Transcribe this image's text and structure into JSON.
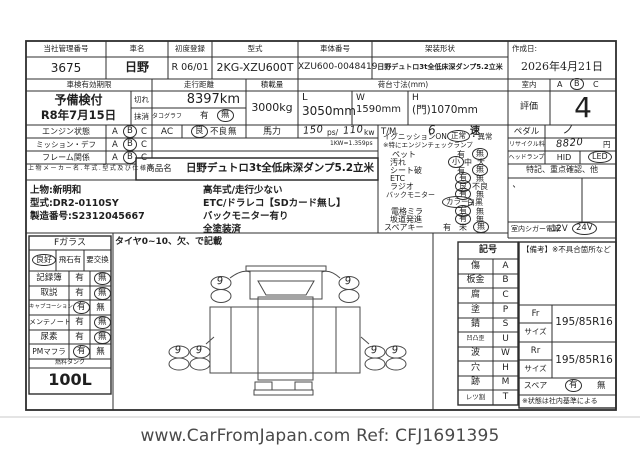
{
  "colors": {
    "ink": "#2d2d2d",
    "paper": "#ffffff",
    "footer_text": "#4a4a4a"
  },
  "top_table": {
    "cols": [
      {
        "label": "当社管理番号",
        "value": "3675"
      },
      {
        "label": "車名",
        "value": "日野"
      },
      {
        "label": "初度登録",
        "value": "R 06/01"
      },
      {
        "label": "型式",
        "value": "2KG-XZU600T"
      },
      {
        "label": "車体番号",
        "value": "XZU600-0048419"
      },
      {
        "label": "架装形状",
        "value": "日野デュトロ3t全低床深ダンプ5.2立米"
      },
      {
        "label": "作成日:",
        "value": "2026年4月21日"
      }
    ]
  },
  "row2": {
    "shaken_label": "車検有効期限",
    "shaken_line1": "予備検付",
    "shaken_line2": "R8年7月15日",
    "kire": "切れ",
    "massho": "抹消",
    "mileage_label": "走行距離",
    "mileage": "8397km",
    "tacho_label": "タコグラフ",
    "tacho_yes": "有",
    "tacho_no": "無",
    "tacho_selected": "無",
    "load_label": "積載量",
    "load": "3000kg",
    "bed_label": "荷台寸法(mm)",
    "bed_l_key": "L",
    "bed_l": "3050mm",
    "bed_w_key": "W",
    "bed_w": "1590mm",
    "bed_h_key": "H",
    "bed_h": "(門)1070mm",
    "interior_label": "室内",
    "opt_a": "A",
    "opt_b": "B",
    "opt_c": "C",
    "interior_selected": "B",
    "grade_label": "評価",
    "grade": "4"
  },
  "condition": {
    "engine_label": "エンジン状態",
    "engine_selected": "B",
    "mission_label": "ミッション・デフ",
    "mission_selected": "B",
    "frame_label": "フレーム関係",
    "frame_selected": "B",
    "a": "A",
    "b": "B",
    "c": "C",
    "ac_label": "AC",
    "ac_good": "良",
    "ac_bad": "不良",
    "ac_none": "無",
    "ac_selected": "良",
    "power_label": "馬力",
    "power_ps": "150",
    "ps_unit": "ps/",
    "power_kw": "110",
    "kw_unit": "kw",
    "kw_note": "1KW=1.359ps",
    "tm_label": "T/M",
    "tm_value": "6",
    "tm_unit": "速",
    "pedal_label": "ペダル",
    "pedal_mark": "ノ",
    "recycle_label": "リサイクル料",
    "recycle_value": "8820",
    "recycle_unit": "円",
    "headlamp_label": "ヘッドランプ",
    "hid": "HID",
    "led": "LED",
    "headlamp_selected": "LED"
  },
  "body_maker": {
    "section_label": "上物メーカー名.年式.型式及び仕様等",
    "product_label": "商品名",
    "product_name": "日野デュトロ3t全低床深ダンプ5.2立米",
    "maker": "上物:新明和",
    "model": "型式:DR2-0110SY",
    "serial": "製造番号:S2312045667",
    "note1": "高年式/走行少ない",
    "note2": "ETC/ドラレコ【SDカード無し】",
    "note3": "バックモニター有り",
    "note4": "全塗装済"
  },
  "checklist": {
    "ignition_label": "イグニッションON",
    "ignition_sel": "正常",
    "ignition_rest": "・異常",
    "ignition_note": "※特にエンジンチェックランプ",
    "items": [
      {
        "label": "ペット",
        "o1": "有",
        "o2": "無",
        "selected": "無"
      },
      {
        "label": "汚れ",
        "o1": "小",
        "o2": "中",
        "o3": "大",
        "selected": "小"
      },
      {
        "label": "シート破",
        "o1": "有",
        "o2": "無",
        "selected": "無"
      },
      {
        "label": "ETC",
        "o1": "有",
        "o2": "無",
        "selected": "有"
      },
      {
        "label": "ラジオ",
        "o1": "良",
        "o2": "不良",
        "selected": "良"
      },
      {
        "label": "バックモニター",
        "o1": "有",
        "o2": "無",
        "selected": "有"
      },
      {
        "label": "",
        "o1": "カラー",
        "o2": "白黒",
        "selected": "カラー"
      },
      {
        "label": "電格ミラ",
        "o1": "有",
        "o2": "無",
        "selected": "有"
      },
      {
        "label": "坂道発進",
        "o1": "有",
        "o2": "無",
        "selected": "有"
      },
      {
        "label": "スペアキー",
        "o1": "有",
        "o2": "未",
        "o3": "無",
        "selected": "無"
      }
    ]
  },
  "right_col": {
    "tokki_header": "特記、重点確認、他",
    "tokki_mark": "、",
    "cigar_label": "室内シガー電源",
    "v12": "12V",
    "v24": "24V",
    "cigar_selected": "24V"
  },
  "left_table": {
    "fglass": "Fガラス",
    "fg1": "良好",
    "fg2": "飛石有",
    "fg3": "要交換",
    "fglass_selected": "良好",
    "rows": [
      {
        "label": "記録簿",
        "yes": "有",
        "no": "無",
        "selected": "無"
      },
      {
        "label": "取説",
        "yes": "有",
        "no": "無",
        "selected": "無"
      },
      {
        "label": "キャブコーション",
        "yes": "有",
        "no": "無",
        "selected": "有"
      },
      {
        "label": "メンテノート",
        "yes": "有",
        "no": "無",
        "selected": "無"
      },
      {
        "label": "尿素",
        "yes": "有",
        "no": "無",
        "selected": "無"
      },
      {
        "label": "PMマフラ",
        "yes": "有",
        "no": "無",
        "selected": "有"
      }
    ],
    "tank_label": "燃料タンク",
    "tank": "100L"
  },
  "tires": {
    "note": "タイヤ0~10、欠、で記載",
    "fl": "9",
    "fr": "9",
    "rl1": "9",
    "rl2": "9",
    "rr1": "9",
    "rr2": "9"
  },
  "legend": {
    "header": "記号",
    "rows": [
      {
        "label": "傷",
        "code": "A"
      },
      {
        "label": "板金",
        "code": "B"
      },
      {
        "label": "腐",
        "code": "C"
      },
      {
        "label": "塗",
        "code": "P"
      },
      {
        "label": "錆",
        "code": "S"
      },
      {
        "label": "凹凸歪",
        "code": "U"
      },
      {
        "label": "波",
        "code": "W"
      },
      {
        "label": "穴",
        "code": "H"
      },
      {
        "label": "跡",
        "code": "M"
      },
      {
        "label": "レツ割",
        "code": "T"
      }
    ]
  },
  "remarks": {
    "header": "【備考】※不具合箇所など",
    "fr": "Fr",
    "size_label": "サイズ",
    "fr_size": "195/85R16",
    "rr": "Rr",
    "rr_size": "195/85R16",
    "spare_label": "スペア",
    "spare_yes": "有",
    "spare_no": "無",
    "spare_selected": "有",
    "note": "※状態は社内基準による"
  },
  "footer": {
    "text": "www.CarFromJapan.com Ref: CFJ1691395"
  }
}
